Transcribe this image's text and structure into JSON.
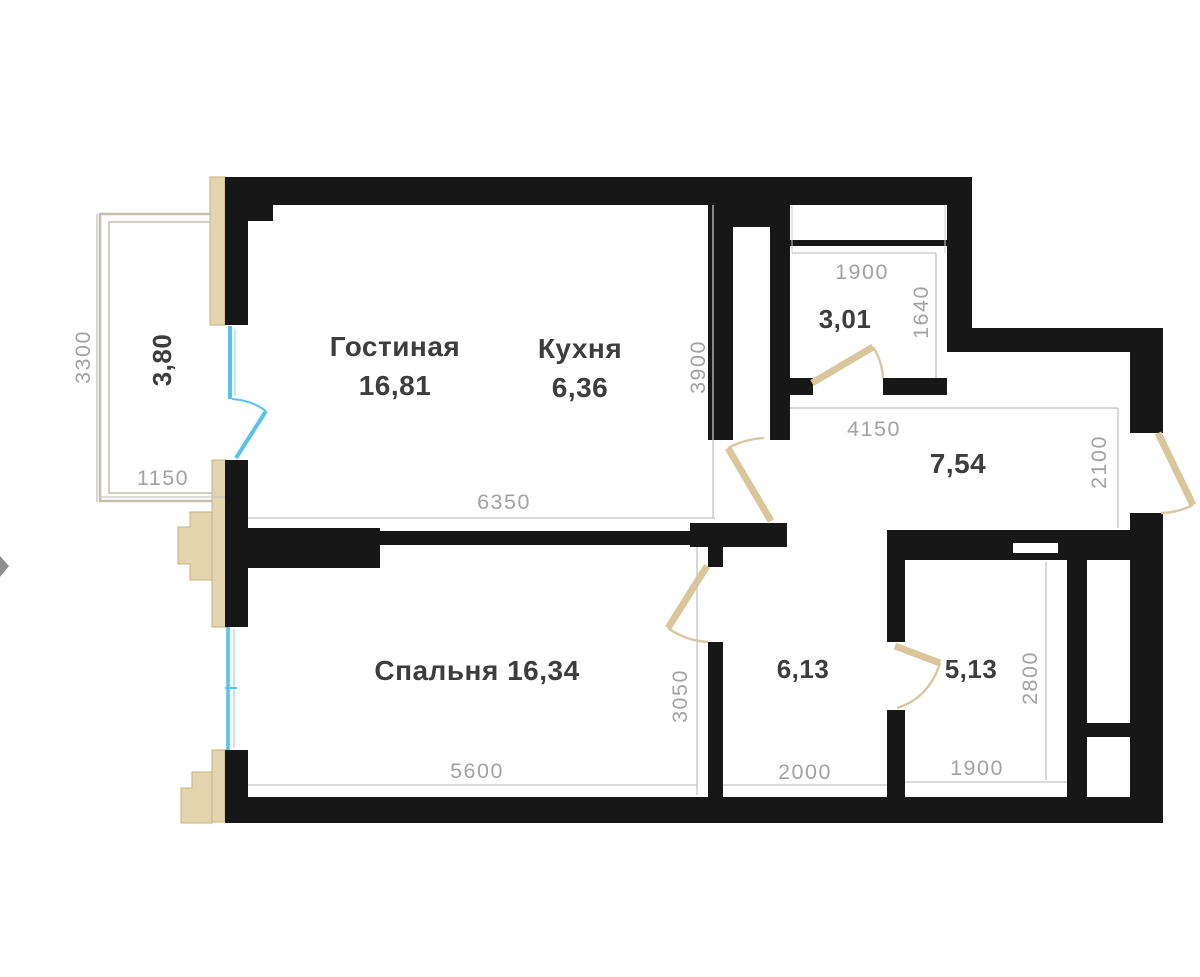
{
  "plan_title": "Apartment floor plan",
  "rooms": {
    "living": {
      "name": "Гостиная",
      "area": "16,81"
    },
    "kitchen": {
      "name": "Кухня",
      "area": "6,36"
    },
    "bedroom": {
      "label": "Спальня 16,34"
    },
    "hallway": {
      "area": "7,54"
    },
    "wardrobe": {
      "area": "3,01"
    },
    "corridor": {
      "area": "6,13"
    },
    "bathroom": {
      "area": "5,13"
    },
    "balcony": {
      "area": "3,80"
    }
  },
  "dimensions": {
    "balcony_height": "3300",
    "balcony_width": "1150",
    "living_width": "6350",
    "living_height": "3900",
    "wardrobe_width": "1900",
    "wardrobe_height": "1640",
    "hallway_width": "4150",
    "hallway_height": "2100",
    "bedroom_width": "5600",
    "corridor_height": "3050",
    "corridor_width": "2000",
    "bathroom_width": "1900",
    "bathroom_height": "2800"
  },
  "colors": {
    "wall": "#171717",
    "window": "#55c4e8",
    "door": "#dac69b",
    "balcony_outline": "#c6bfae",
    "dimension_text": "#a2a2a2",
    "label_text": "#3d3d3d",
    "background": "#ffffff"
  }
}
